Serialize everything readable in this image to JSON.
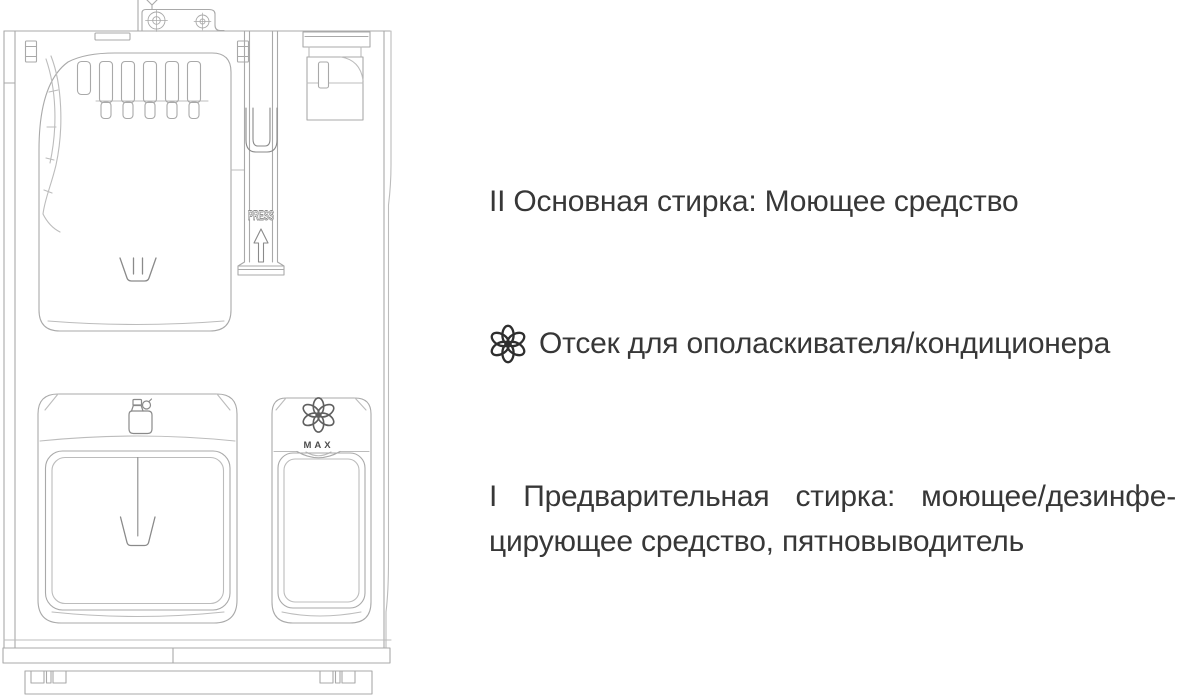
{
  "background": "#ffffff",
  "text_color": "#373737",
  "labels": {
    "main_wash": {
      "marker": "II",
      "text": "II Основная стирка: Моющее средство"
    },
    "softener": {
      "icon": "flower-icon",
      "text": "Отсек для ополаскивателя/кондиционера"
    },
    "prewash": {
      "marker": "I",
      "line1": "I Предварительная стирка: моющее/дезинфе-",
      "line2": "цирующее средство, пятновыводитель"
    }
  },
  "diagram": {
    "name": "washing-machine-detergent-drawer-schematic",
    "press_label": "PRESS",
    "max_label": "MAX",
    "icons": [
      "hinge-screws-icon",
      "main-wash-cup-icon",
      "press-arrow-icon",
      "detergent-bottle-icon",
      "prewash-cup-icon",
      "flower-icon",
      "max-level-mark"
    ],
    "colors": {
      "line": "#a9a9a9",
      "light_line": "#bcbcbc",
      "dark_line": "#8a8a8a",
      "mark_text": "#4d4d4d"
    }
  }
}
